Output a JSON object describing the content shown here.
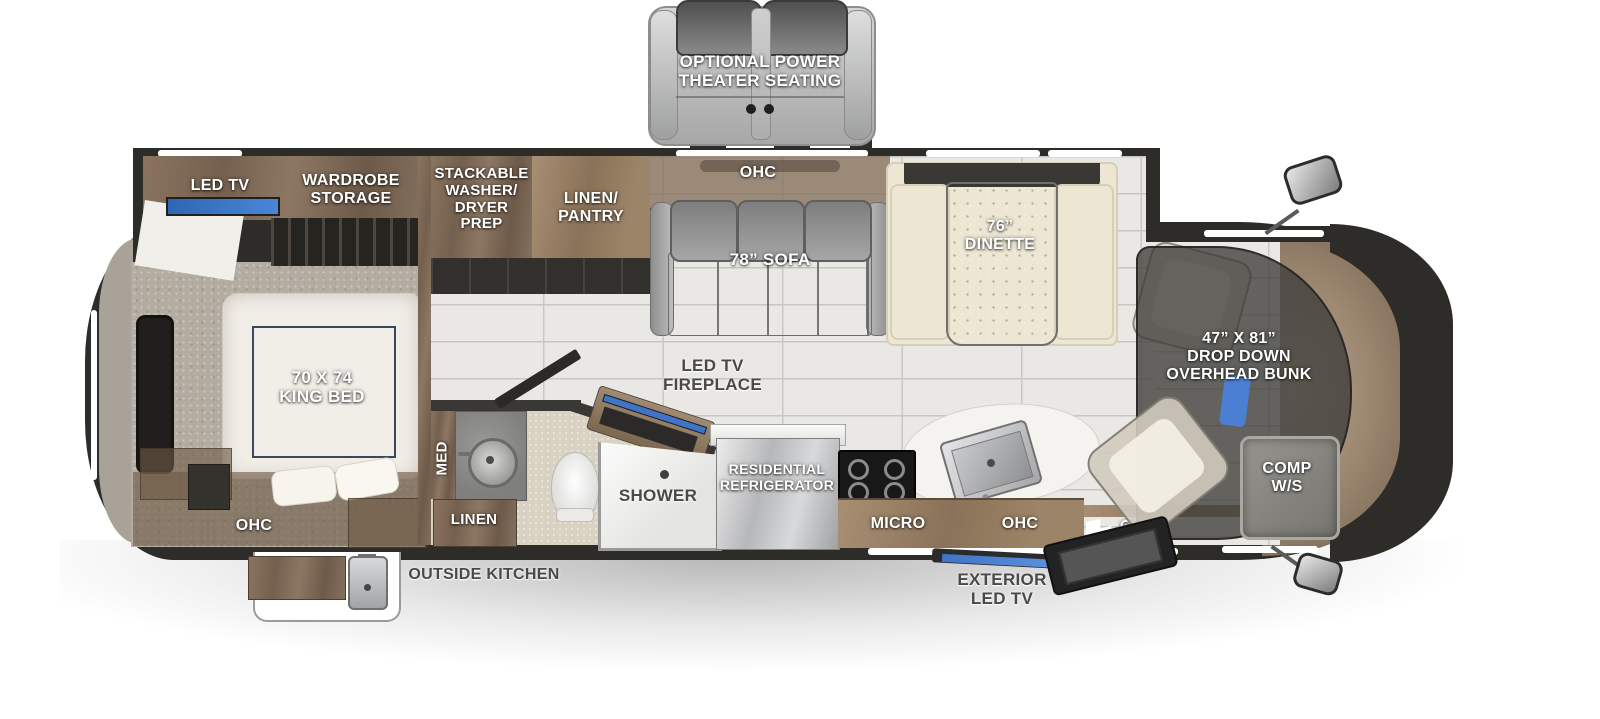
{
  "meta": {
    "kind": "RV motorhome floor plan diagram"
  },
  "colors": {
    "wall_dark": "#2e2c29",
    "wood_brown": "#806953",
    "accent_blue": "#3f74c6",
    "floor_tile": "#e9e8e4",
    "carpet_gray": "#b3aca1",
    "label_white": "#ffffff",
    "label_gray": "#4a4947",
    "dinette_cream": "#ece6d2",
    "sofa_gray": "#9c9c9c"
  },
  "exterior": {
    "theater_seating": "OPTIONAL POWER\nTHEATER SEATING",
    "outside_kitchen": "OUTSIDE KITCHEN",
    "exterior_led_tv": "EXTERIOR\nLED TV"
  },
  "rear_slide": {
    "led_tv": "LED TV",
    "wardrobe": "WARDROBE\nSTORAGE"
  },
  "bedroom": {
    "king_bed": "70 X 74\nKING BED",
    "ohc": "OHC"
  },
  "utility": {
    "washer_dryer": "STACKABLE\nWASHER/\nDRYER\nPREP",
    "linen_pantry": "LINEN/\nPANTRY"
  },
  "living": {
    "ohc": "OHC",
    "sofa": "78” SOFA",
    "dinette": "76”\nDINETTE",
    "tv_fireplace": "LED TV\nFIREPLACE"
  },
  "bath": {
    "med": "MED",
    "linen": "LINEN",
    "shower": "SHOWER"
  },
  "kitchen": {
    "refrigerator": "RESIDENTIAL\nREFRIGERATOR",
    "micro": "MICRO",
    "ohc": "OHC"
  },
  "entry": {
    "ohc": "OHC"
  },
  "cab": {
    "overhead_bunk": "47” X 81”\nDROP DOWN\nOVERHEAD BUNK",
    "comp_ws": "COMP\nW/S"
  }
}
